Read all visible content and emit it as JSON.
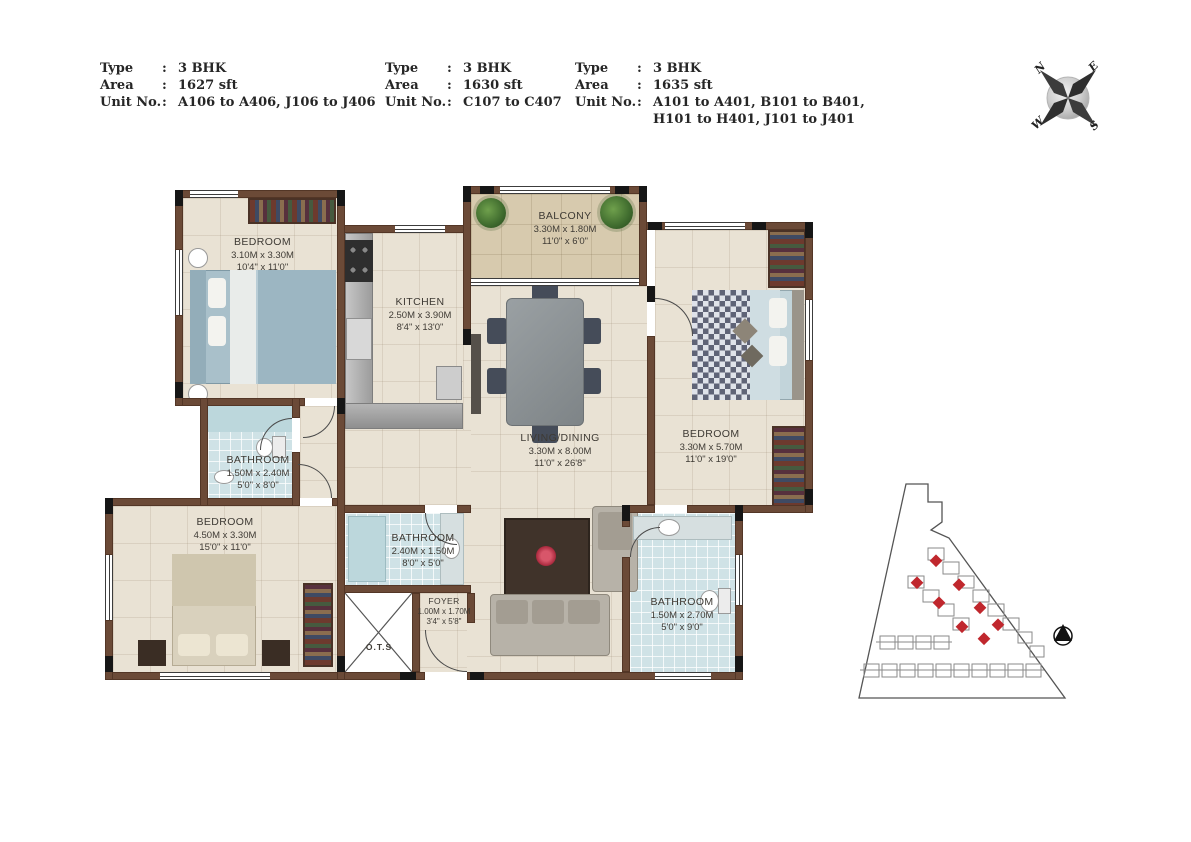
{
  "legend_blocks": [
    {
      "rows": [
        {
          "label": "Type",
          "colon": ":",
          "value": "3 BHK"
        },
        {
          "label": "Area",
          "colon": ":",
          "value": "1627 sft"
        },
        {
          "label": "Unit No.",
          "colon": ":",
          "value": "A106 to A406, J106 to J406"
        }
      ]
    },
    {
      "rows": [
        {
          "label": "Type",
          "colon": ":",
          "value": "3 BHK"
        },
        {
          "label": "Area",
          "colon": ":",
          "value": "1630 sft"
        },
        {
          "label": "Unit No.",
          "colon": ":",
          "value": "C107 to C407"
        }
      ]
    },
    {
      "rows": [
        {
          "label": "Type",
          "colon": ":",
          "value": "3 BHK"
        },
        {
          "label": "Area",
          "colon": ":",
          "value": "1635 sft"
        },
        {
          "label": "Unit No.",
          "colon": ":",
          "value": "A101 to A401, B101 to B401,"
        },
        {
          "label": "",
          "colon": "",
          "value": "H101 to H401, J101 to J401"
        }
      ]
    }
  ],
  "compass": {
    "n": "N",
    "e": "E",
    "s": "S",
    "w": "W"
  },
  "rooms": {
    "bedroom_tl": {
      "name": "BEDROOM",
      "metric": "3.10M x 3.30M",
      "imperial": "10'4\" x 11'0\""
    },
    "kitchen": {
      "name": "KITCHEN",
      "metric": "2.50M x 3.90M",
      "imperial": "8'4\" x 13'0\""
    },
    "balcony": {
      "name": "BALCONY",
      "metric": "3.30M x 1.80M",
      "imperial": "11'0\" x 6'0\""
    },
    "living_dining": {
      "name": "LIVING/DINING",
      "metric": "3.30M x 8.00M",
      "imperial": "11'0\" x 26'8\""
    },
    "bedroom_right": {
      "name": "BEDROOM",
      "metric": "3.30M x 5.70M",
      "imperial": "11'0\" x 19'0\""
    },
    "bathroom_top": {
      "name": "BATHROOM",
      "metric": "1.50M x 2.40M",
      "imperial": "5'0\" x 8'0\""
    },
    "bedroom_bl": {
      "name": "BEDROOM",
      "metric": "4.50M x 3.30M",
      "imperial": "15'0\" x 11'0\""
    },
    "bathroom_mid": {
      "name": "BATHROOM",
      "metric": "2.40M x 1.50M",
      "imperial": "8'0\" x 5'0\""
    },
    "foyer": {
      "name": "FOYER",
      "metric": "1.00M x 1.70M",
      "imperial": "3'4\" x 5'8\""
    },
    "bathroom_br": {
      "name": "BATHROOM",
      "metric": "1.50M x 2.70M",
      "imperial": "5'0\" x 9'0\""
    },
    "ots": {
      "name": "O.T.S"
    }
  },
  "colors": {
    "wall": "#6b4a37",
    "floor": "#e9e2d4",
    "bath_tile": "#cfe2e6",
    "balcony": "#d7caae",
    "unit_highlight": "#c0272d"
  }
}
